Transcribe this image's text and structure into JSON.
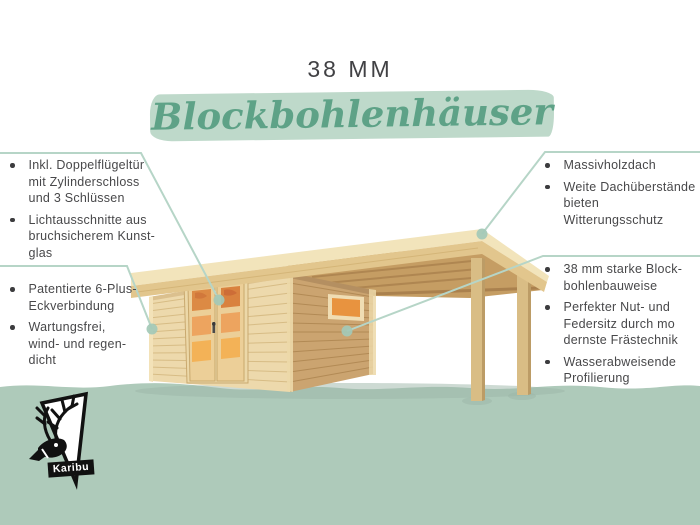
{
  "title": {
    "size": "38 MM",
    "product": "Blockbohlenhäuser"
  },
  "features": {
    "top_left": [
      "Inkl. Doppelflügeltür\nmit Zylinderschloss\nund 3 Schlüssen",
      "Lichtausschnitte aus\nbruchsicherem Kunst-\nglas"
    ],
    "bottom_left": [
      "Patentierte 6-Plus-\nEckverbindung",
      "Wartungsfrei,\nwind- und regen-\ndicht"
    ],
    "top_right": [
      "Massivholzdach",
      "Weite Dachüberstände\nbieten Witterungsschutz"
    ],
    "bottom_right": [
      "38 mm starke Block-\nbohlenbauweise",
      "Perfekter Nut- und\nFedersitz durch mo\ndernste Frästechnik",
      "Wasserabweisende\nProfilierung"
    ]
  },
  "logo": {
    "brand": "Karibu"
  },
  "icons": {
    "bullet": "bullet-dot",
    "callout_dot": "callout-endpoint-dot",
    "deer": "caribou-head-logo"
  },
  "colors": {
    "c-title": "#414144",
    "c-text": "#48484a",
    "c-heading": "#5ea287",
    "c-brush": "#bed9ca",
    "c-line": "#b6d5c7",
    "c-dot": "#a3c9b7",
    "c-ground": "#aecaba",
    "c-shadow": "#9bb6a8",
    "wood-top": "#f2e4bb",
    "wood-fascia": "#e2c68d",
    "wood-soffit": "#c59d63",
    "wood-rafter": "#a87f4c",
    "wood-facade": "#edd9ac",
    "wood-plank": "#d7bc85",
    "wood-side": "#cba470",
    "wood-side-plank": "#b28a55",
    "wood-trim": "#ecd8a8",
    "wood-door": "#eccf98",
    "glass-1": "#db8a44",
    "glass-2": "#eda45f",
    "glass-3": "#f3b257",
    "wood-post": "#d9bd85",
    "wood-post-shade": "#bc9c66"
  }
}
